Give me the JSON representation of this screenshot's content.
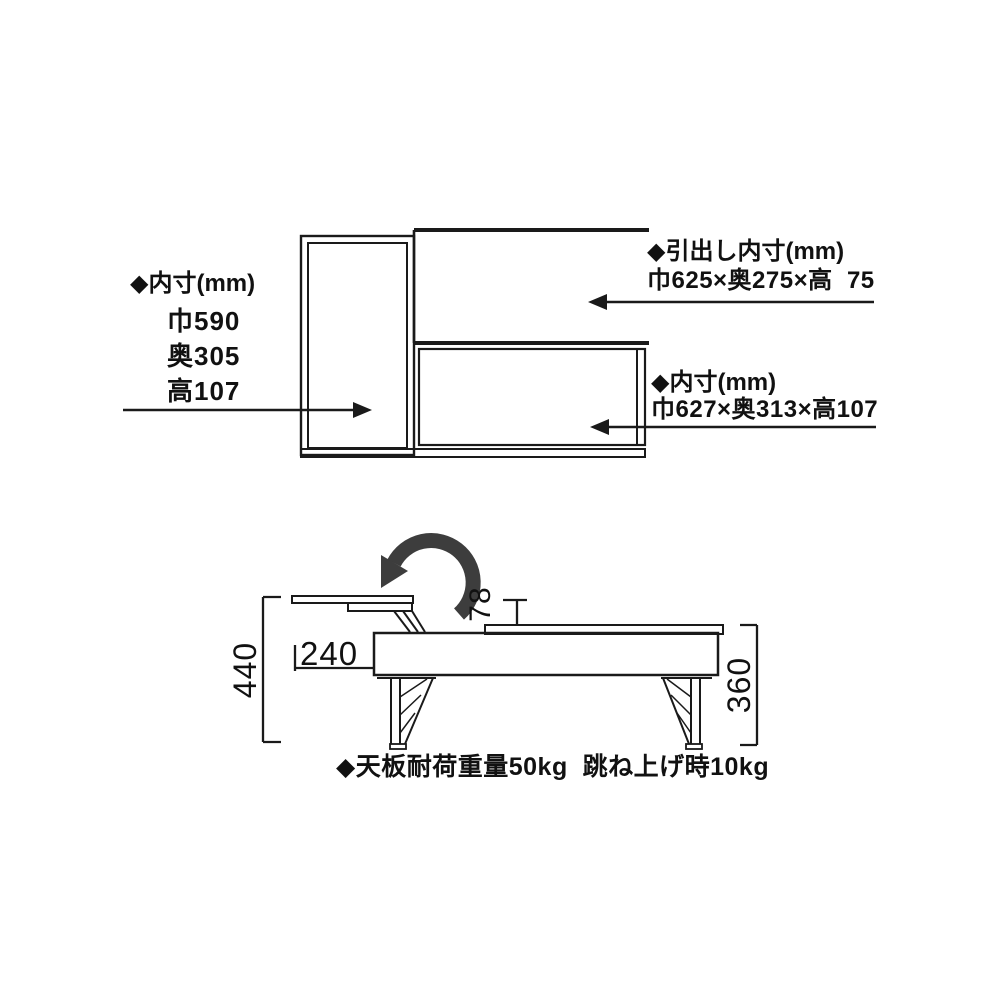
{
  "page": {
    "bg_color": "#ffffff",
    "line_color": "#1a1a1a",
    "rotate_arrow_color": "#3d3d3d"
  },
  "front_view": {
    "inner_label": {
      "title": "◆内寸(mm)",
      "lines": [
        "巾590",
        "奥305",
        "高107"
      ]
    },
    "drawer_label": {
      "title": "◆引出し内寸(mm)",
      "dims": "巾625×奥275×高  75"
    },
    "lower_inner_label": {
      "title": "◆内寸(mm)",
      "dims": "巾627×奥313×高107"
    }
  },
  "side_view": {
    "overall_height_mm": "440",
    "top_depth_mm": "240",
    "lift_gap_mm": "78",
    "leg_height_mm": "360",
    "caption": "◆天板耐荷重量50kg  跳ね上げ時10kg"
  }
}
